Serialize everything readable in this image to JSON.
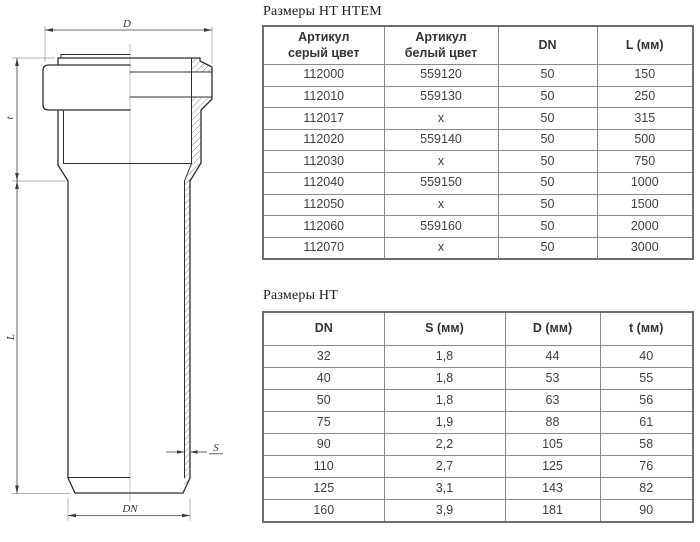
{
  "drawing": {
    "dim_labels": {
      "D": "D",
      "t": "t",
      "L": "L",
      "S": "S",
      "DN": "DN"
    }
  },
  "tables": {
    "htem": {
      "title": "Размеры HT HTEM",
      "columns": [
        "Артикул\nсерый цвет",
        "Артикул\nбелый цвет",
        "DN",
        "L (мм)"
      ],
      "rows": [
        [
          "112000",
          "559120",
          "50",
          "150"
        ],
        [
          "112010",
          "559130",
          "50",
          "250"
        ],
        [
          "112017",
          "x",
          "50",
          "315"
        ],
        [
          "112020",
          "559140",
          "50",
          "500"
        ],
        [
          "112030",
          "x",
          "50",
          "750"
        ],
        [
          "112040",
          "559150",
          "50",
          "1000"
        ],
        [
          "112050",
          "x",
          "50",
          "1500"
        ],
        [
          "112060",
          "559160",
          "50",
          "2000"
        ],
        [
          "112070",
          "x",
          "50",
          "3000"
        ]
      ]
    },
    "ht": {
      "title": "Размеры HT",
      "columns": [
        "DN",
        "S (мм)",
        "D (мм)",
        "t (мм)"
      ],
      "rows": [
        [
          "32",
          "1,8",
          "44",
          "40"
        ],
        [
          "40",
          "1,8",
          "53",
          "55"
        ],
        [
          "50",
          "1,8",
          "63",
          "56"
        ],
        [
          "75",
          "1,9",
          "88",
          "61"
        ],
        [
          "90",
          "2,2",
          "105",
          "58"
        ],
        [
          "110",
          "2,7",
          "125",
          "76"
        ],
        [
          "125",
          "3,1",
          "143",
          "82"
        ],
        [
          "160",
          "3,9",
          "181",
          "90"
        ]
      ]
    }
  },
  "colors": {
    "outline": "#2e2e2e",
    "thin_line": "#9a9a9a",
    "table_border": "#8a8a8a",
    "text": "#3f3f3f"
  }
}
